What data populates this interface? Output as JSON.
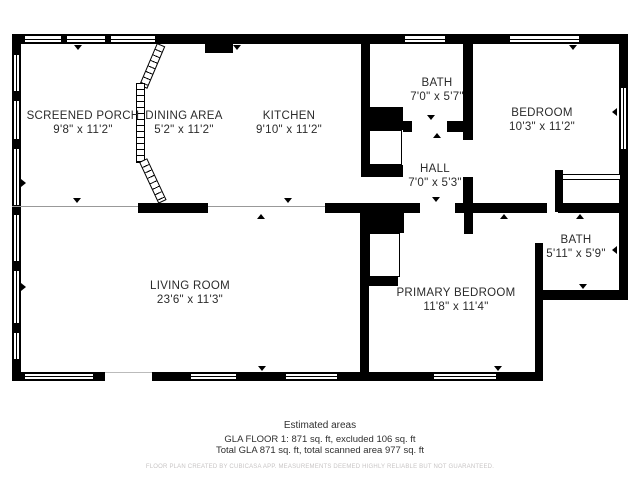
{
  "colors": {
    "wall": "#000000",
    "open_boundary_line": "#999999",
    "text": "#2b2b2b",
    "fine_print": "#c8c5c5"
  },
  "rooms": [
    {
      "name": "SCREENED PORCH",
      "dims": "9'8\" x 11'2\""
    },
    {
      "name": "DINING AREA",
      "dims": "5'2\" x 11'2\""
    },
    {
      "name": "KITCHEN",
      "dims": "9'10\" x 11'2\""
    },
    {
      "name": "BATH",
      "dims": "7'0\" x 5'7\""
    },
    {
      "name": "BEDROOM",
      "dims": "10'3\" x 11'2\""
    },
    {
      "name": "HALL",
      "dims": "7'0\" x 5'3\""
    },
    {
      "name": "LIVING ROOM",
      "dims": "23'6\" x 11'3\""
    },
    {
      "name": "PRIMARY BEDROOM",
      "dims": "11'8\" x 11'4\""
    },
    {
      "name": "BATH",
      "dims": "5'11\" x 5'9\""
    }
  ],
  "footer": {
    "title": "Estimated areas",
    "line1": "GLA FLOOR 1: 871 sq. ft, excluded 106 sq. ft",
    "line2": "Total GLA 871 sq. ft, total scanned area 977 sq. ft",
    "fine_print": "FLOOR PLAN CREATED BY CUBICASA APP. MEASUREMENTS DEEMED HIGHLY RELIABLE BUT NOT GUARANTEED."
  }
}
